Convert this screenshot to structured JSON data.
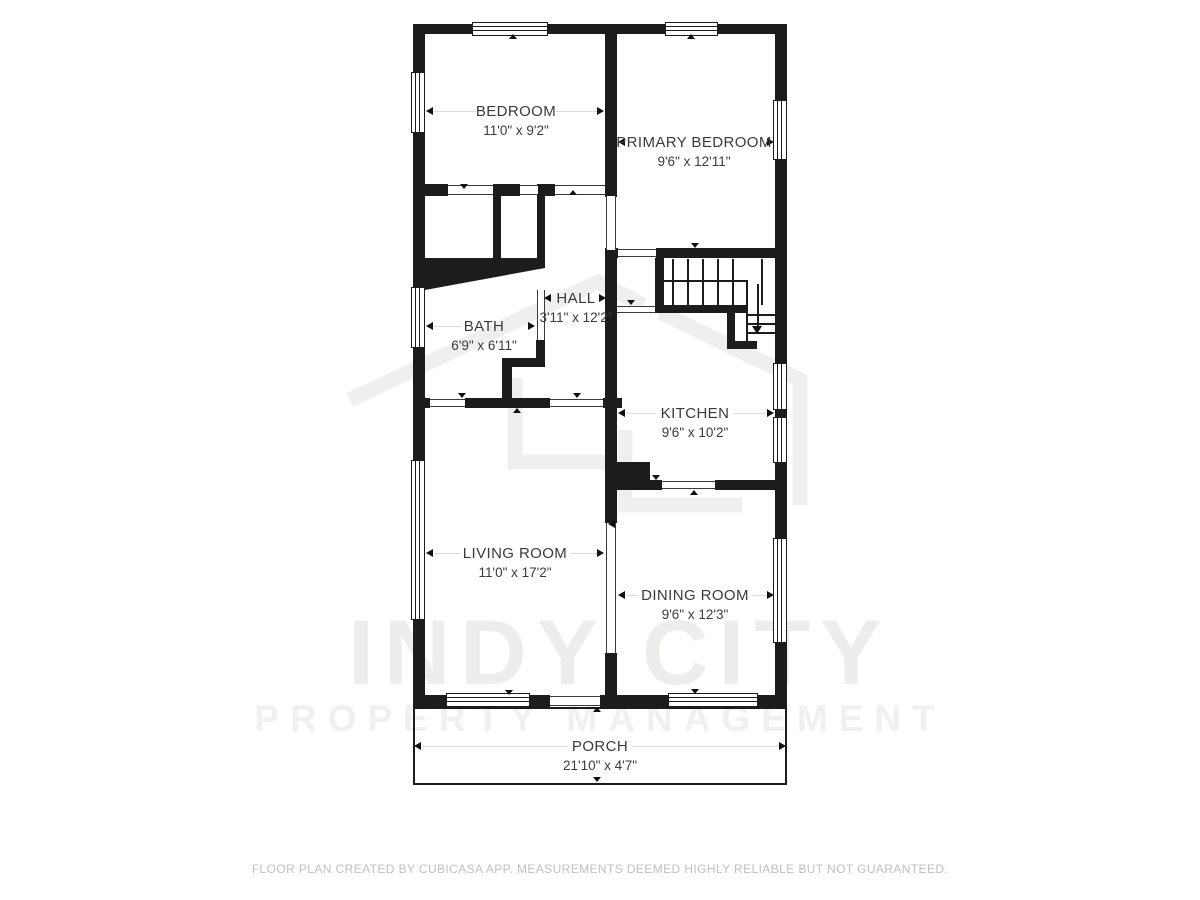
{
  "watermark": {
    "line1": "INDY CITY",
    "line2": "PROPERTY MANAGEMENT"
  },
  "rooms": {
    "bedroom": {
      "name": "BEDROOM",
      "dims": "11'0\" x 9'2\""
    },
    "primary_bedroom": {
      "name": "PRIMARY BEDROOM",
      "dims": "9'6\" x 12'11\""
    },
    "hall": {
      "name": "HALL",
      "dims": "3'11\" x 12'2\""
    },
    "bath": {
      "name": "BATH",
      "dims": "6'9\" x 6'11\""
    },
    "kitchen": {
      "name": "KITCHEN",
      "dims": "9'6\" x 10'2\""
    },
    "living_room": {
      "name": "LIVING ROOM",
      "dims": "11'0\" x 17'2\""
    },
    "dining_room": {
      "name": "DINING ROOM",
      "dims": "9'6\" x 12'3\""
    },
    "porch": {
      "name": "PORCH",
      "dims": "21'10\" x 4'7\""
    }
  },
  "footer": {
    "disclaimer": "FLOOR PLAN CREATED BY CUBICASA APP. MEASUREMENTS DEEMED HIGHLY RELIABLE BUT NOT GUARANTEED."
  },
  "colors": {
    "wall": "#1c1c1c",
    "label_text": "#3b3b3b",
    "footer_text": "#c2c0be",
    "watermark_text": "#efedeb"
  }
}
